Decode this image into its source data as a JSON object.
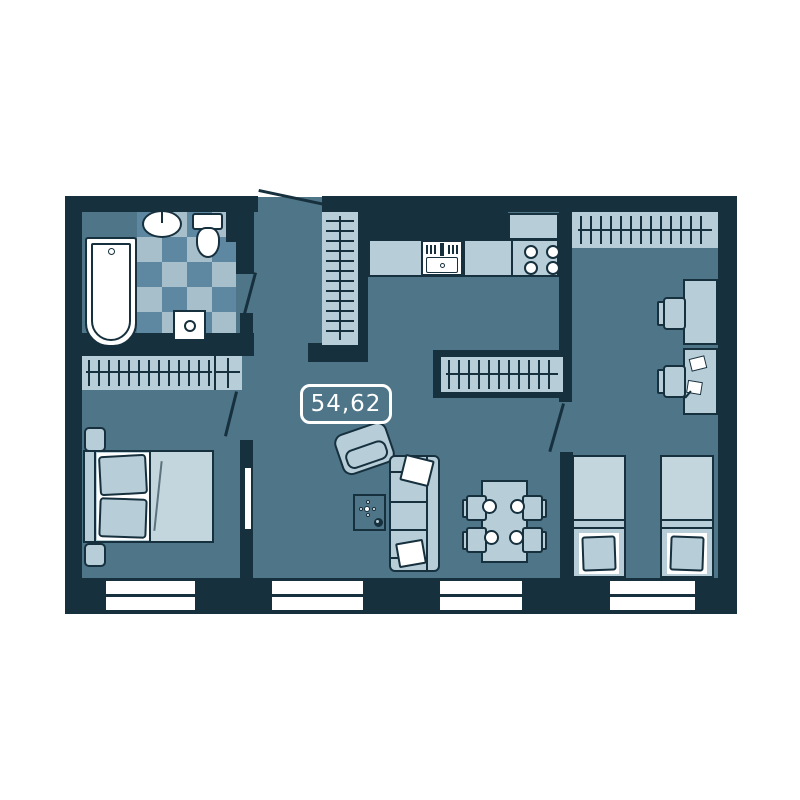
{
  "floor_plan": {
    "area_label": "54,62",
    "colors": {
      "wall": "#16303e",
      "floor": "#4e7588",
      "lite": "#b7cdd8",
      "lite2": "#c3d6de",
      "chk-l": "#a6bfca",
      "chk-d": "#5e87a2",
      "fix": "#ffffff",
      "label": "#ffffff"
    },
    "window_count": 4,
    "door_count": 4,
    "rooms": {
      "bathroom": [
        "bathtub",
        "wash-basin",
        "toilet",
        "washing-machine",
        "tiled-floor"
      ],
      "hallway": [
        "entrance-door",
        "hall-wardrobe",
        "hall-wardrobe-2"
      ],
      "kitchen": [
        "counter",
        "kitchen-sink",
        "stove"
      ],
      "living-room": [
        "armchair",
        "sofa",
        "coffee-table",
        "dining-table",
        "four-chairs",
        "tv"
      ],
      "bedroom": [
        "wardrobe",
        "double-bed",
        "nightstand-1",
        "nightstand-2"
      ],
      "kids-room": [
        "wardrobe",
        "desk-1",
        "desk-2",
        "chair-1",
        "chair-2",
        "single-bed-1",
        "single-bed-2"
      ]
    }
  }
}
